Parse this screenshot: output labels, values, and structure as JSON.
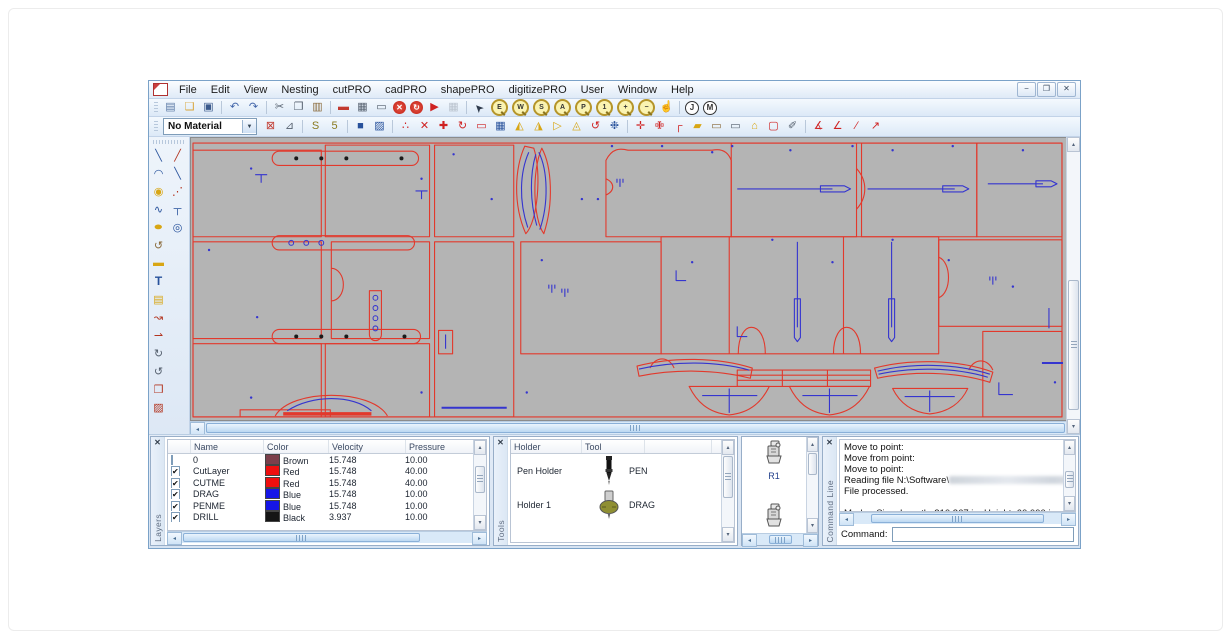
{
  "window": {
    "controls": [
      {
        "name": "minimize-button",
        "glyph": "−"
      },
      {
        "name": "restore-button",
        "glyph": "❐"
      },
      {
        "name": "close-button",
        "glyph": "✕"
      }
    ]
  },
  "menu": {
    "items": [
      "File",
      "Edit",
      "View",
      "Nesting",
      "cutPRO",
      "cadPRO",
      "shapePRO",
      "digitizePRO",
      "User",
      "Window",
      "Help"
    ]
  },
  "toolbar_main": {
    "groups": [
      [
        {
          "n": "new-drawing-icon",
          "g": "▤",
          "c": "#5b79a5"
        },
        {
          "n": "open-file-icon",
          "g": "❑",
          "c": "#d9a437"
        },
        {
          "n": "save-icon",
          "g": "▣",
          "c": "#3b5a8c"
        }
      ],
      [
        {
          "n": "undo-icon",
          "g": "↶",
          "c": "#3f63a8"
        },
        {
          "n": "redo-icon",
          "g": "↷",
          "c": "#3f63a8"
        }
      ],
      [
        {
          "n": "cut-icon",
          "g": "✂",
          "c": "#55606e"
        },
        {
          "n": "copy-icon",
          "g": "❐",
          "c": "#55606e"
        },
        {
          "n": "paste-icon",
          "g": "▥",
          "c": "#8a6a3a"
        }
      ],
      [
        {
          "n": "material-editor-icon",
          "g": "▬",
          "c": "#c23a2f"
        },
        {
          "n": "plot-setup-icon",
          "g": "▦",
          "c": "#55606e"
        },
        {
          "n": "machine-setup-icon",
          "g": "▭",
          "c": "#55606e"
        },
        {
          "n": "stop-icon",
          "g": "✕",
          "k": "circ-red"
        },
        {
          "n": "restart-icon",
          "g": "↻",
          "k": "circ-red"
        },
        {
          "n": "start-icon",
          "g": "▶",
          "c": "#cf2222"
        },
        {
          "n": "pause-icon",
          "g": "▦",
          "c": "#b9c2cd"
        }
      ],
      [
        {
          "n": "select-cursor-icon",
          "g": "➤",
          "c": "#2f3b4c",
          "k": "rot225"
        },
        {
          "n": "zoom-extents-icon",
          "lens": "E"
        },
        {
          "n": "zoom-window-icon",
          "lens": "W"
        },
        {
          "n": "zoom-selected-icon",
          "lens": "S"
        },
        {
          "n": "zoom-all-icon",
          "lens": "A"
        },
        {
          "n": "zoom-previous-icon",
          "lens": "P"
        },
        {
          "n": "zoom-scale-icon",
          "lens": "1"
        },
        {
          "n": "zoom-in-icon",
          "lens": "+"
        },
        {
          "n": "zoom-out-icon",
          "lens": "−"
        },
        {
          "n": "pan-hand-icon",
          "g": "☝",
          "c": "#c59f33"
        }
      ],
      [
        {
          "n": "job-tool-icon",
          "circle": "J"
        },
        {
          "n": "machine-tool-icon",
          "circle": "M"
        }
      ]
    ]
  },
  "toolbar_secondary": {
    "material_select": {
      "value": "No Material"
    },
    "groups": [
      [
        {
          "n": "delete-material-icon",
          "g": "⊠",
          "c": "#c23a2f"
        },
        {
          "n": "measure-icon",
          "g": "⊿",
          "c": "#55606e"
        }
      ],
      [
        {
          "n": "step-repeat-icon",
          "g": "S",
          "c": "#8a7a1f"
        },
        {
          "n": "step-repeat-add-icon",
          "g": "5",
          "c": "#8a7a1f"
        }
      ],
      [
        {
          "n": "fill-dark-icon",
          "g": "■",
          "c": "#27519b"
        },
        {
          "n": "fill-light-icon",
          "g": "▨",
          "c": "#27519b"
        }
      ],
      [
        {
          "n": "point-edit-icon",
          "g": "∴",
          "c": "#cf2222"
        },
        {
          "n": "delete-icon",
          "g": "✕",
          "c": "#cf2222"
        },
        {
          "n": "move-icon",
          "g": "✚",
          "c": "#cf2222"
        },
        {
          "n": "rotate-icon",
          "g": "↻",
          "c": "#cf2222"
        },
        {
          "n": "properties-icon",
          "g": "▭",
          "c": "#cf2222"
        },
        {
          "n": "array-icon",
          "g": "▦",
          "c": "#27519b"
        },
        {
          "n": "mirror-horizontal-icon",
          "g": "◭",
          "c": "#d8a614"
        },
        {
          "n": "mirror-vertical-icon",
          "g": "◮",
          "c": "#d8a614"
        },
        {
          "n": "skew-icon",
          "g": "▷",
          "c": "#d8a614"
        },
        {
          "n": "align-warning-icon",
          "g": "◬",
          "c": "#d8a614"
        },
        {
          "n": "rotate-ccw-icon",
          "g": "↺",
          "c": "#cf2222"
        },
        {
          "n": "spray-icon",
          "g": "❉",
          "c": "#27519b"
        }
      ],
      [
        {
          "n": "break-line-icon",
          "g": "✛",
          "c": "#cf2222"
        },
        {
          "n": "join-line-icon",
          "g": "✙",
          "c": "#cf2222"
        },
        {
          "n": "corner-icon",
          "g": "┌",
          "c": "#cf2222"
        },
        {
          "n": "fillet-icon",
          "g": "▰",
          "c": "#d8a614"
        },
        {
          "n": "open-shape-icon",
          "g": "▭",
          "c": "#8a6a3a"
        },
        {
          "n": "close-shape-icon",
          "g": "▭",
          "c": "#55606e"
        },
        {
          "n": "polygon-icon",
          "g": "⌂",
          "c": "#d8a614"
        },
        {
          "n": "marquee-icon",
          "g": "▢",
          "c": "#cf2222"
        },
        {
          "n": "knife-icon",
          "g": "✐",
          "c": "#55606e"
        }
      ],
      [
        {
          "n": "angle-measure-icon",
          "g": "∡",
          "c": "#cf2222"
        },
        {
          "n": "angle-icon",
          "g": "∠",
          "c": "#cf2222"
        },
        {
          "n": "segment-icon",
          "g": "∕",
          "c": "#cf2222"
        },
        {
          "n": "segment-points-icon",
          "g": "↗",
          "c": "#cf2222"
        }
      ]
    ]
  },
  "toolbox": {
    "left_column": [
      {
        "n": "line-tool-icon",
        "g": "╲",
        "c": "#27519b"
      },
      {
        "n": "arc-tool-icon",
        "g": "◠",
        "c": "#27519b"
      },
      {
        "n": "circle-tool-icon",
        "g": "◉",
        "c": "#d8a614"
      },
      {
        "n": "polyline-tool-icon",
        "g": "∿",
        "c": "#27519b"
      },
      {
        "n": "ellipse-tool-icon",
        "g": "●",
        "c": "#d8a614",
        "k": "stretchx"
      },
      {
        "n": "revolve-tool-icon",
        "g": "↺",
        "c": "#8a6a3a"
      },
      {
        "n": "rectangle-tool-icon",
        "g": "▬",
        "c": "#d8a614"
      },
      {
        "n": "text-tool-icon",
        "g": "T",
        "c": "#27519b",
        "k": "boldT"
      },
      {
        "n": "dimension-tool-icon",
        "g": "▤",
        "c": "#d8a614"
      },
      {
        "n": "edit-points-tool-icon",
        "g": "↝",
        "c": "#b2341f"
      },
      {
        "n": "vector-tool-icon",
        "g": "⇀",
        "c": "#b2341f"
      },
      {
        "n": "rotate-cw-tool-icon",
        "g": "↻",
        "c": "#55606e"
      },
      {
        "n": "rotate-ccw-tool-icon",
        "g": "↺",
        "c": "#55606e"
      },
      {
        "n": "send-to-cut-icon",
        "g": "❒",
        "c": "#b2341f"
      },
      {
        "n": "export-marker-icon",
        "g": "▨",
        "c": "#b2341f"
      }
    ],
    "right_column": [
      {
        "n": "point-on-line-tool-icon",
        "g": "╱",
        "c": "#b2341f"
      },
      {
        "n": "offset-line-tool-icon",
        "g": "╲",
        "c": "#27519b"
      },
      {
        "n": "divide-line-tool-icon",
        "g": "⋰",
        "c": "#b2341f"
      },
      {
        "n": "tee-point-tool-icon",
        "g": "┬",
        "c": "#27519b"
      },
      {
        "n": "center-point-tool-icon",
        "g": "◎",
        "c": "#27519b"
      }
    ]
  },
  "canvas": {
    "bg": "#b4b4b4",
    "stroke_red": "#e2392c",
    "stroke_blue": "#3535cf",
    "dot_black": "#1a1a1a",
    "red_paths": [
      {
        "d": "M2,5H869V274H2Z"
      },
      {
        "d": "M2,12H130V97H2Z"
      },
      {
        "d": "M2,102H130V197H2Z"
      },
      {
        "d": "M2,202H130V274H2Z"
      },
      {
        "d": "M88,13H220a7,7 0 0 1 0,14H88a7,7 0 0 1 0,-14Z"
      },
      {
        "d": "M88,96H216a7,7 0 0 1 0,14H88a7,7 0 0 1 0,-14Z"
      },
      {
        "d": "M88,188H222a7,7 0 0 1 0,14H88a7,7 0 0 1 0,-14Z"
      },
      {
        "d": "M178,150H190V193a6,6 0 0 1 -12,0Z"
      },
      {
        "d": "M134,7H238V97H134Z"
      },
      {
        "d": "M140,102H238V197H140Z"
      },
      {
        "d": "M140,128a12,16 0 0 1 0,32"
      },
      {
        "d": "M134,202H238V274H134Z"
      },
      {
        "d": "M243,7H322V97H243Z"
      },
      {
        "d": "M243,102H322V274H243Z"
      },
      {
        "d": "M247,189h14v23h-14z"
      },
      {
        "d": "M333,8C323,30 321,65 334,94C346,82 350,34 342,10Z"
      },
      {
        "d": "M350,10C360,28 362,64 352,94C341,79 340,32 350,10Z"
      },
      {
        "d": "M414,22C420,10 428,10 436,12L520,12C530,10 536,14 539,22L539,97L414,97Z"
      },
      {
        "d": "M414,40C423,44 423,52 414,56"
      },
      {
        "d": "M539,5H664V97H539Z"
      },
      {
        "d": "M664,30C675,42 675,58 664,70"
      },
      {
        "d": "M669,5H784V97H669Z"
      },
      {
        "d": "M784,5H869V97H784Z"
      },
      {
        "d": "M329,102H469V212H329Z"
      },
      {
        "d": "M469,97H746V212H469Z"
      },
      {
        "d": "M537,97V212"
      },
      {
        "d": "M651,97V212"
      },
      {
        "d": "M546,212C546,194 553,186 559,186C566,186 573,194 573,212"
      },
      {
        "d": "M641,212C641,194 648,186 654,186C661,186 668,194 668,212"
      },
      {
        "d": "M746,100H869V185H746Z"
      },
      {
        "d": "M746,117C759,122 759,152 746,157"
      },
      {
        "d": "M790,190H869V274H790Z"
      },
      {
        "d": "M84,273C100,246 180,246 196,273"
      },
      {
        "d": "M92,271H180",
        "w": 3.5
      },
      {
        "d": "M445,224C480,215 525,215 560,226L558,236C523,227 482,227 447,234Z"
      },
      {
        "d": "M545,228H678V244H545Z"
      },
      {
        "d": "M545,233H678"
      },
      {
        "d": "M545,238H678"
      },
      {
        "d": "M590,228V244"
      },
      {
        "d": "M635,228V244"
      },
      {
        "d": "M682,226C716,217 764,217 800,230L797,240C762,229 718,229 685,236Z"
      },
      {
        "d": "M497,244H577C570,258 559,270 537,272C515,270 504,258 497,244Z"
      },
      {
        "d": "M597,244H677C670,258 659,270 637,272C615,270 604,258 597,244Z"
      },
      {
        "d": "M700,246H775C769,259 757,269 737,271C717,269 706,258 700,246Z"
      },
      {
        "d": "M49,267H139V274H49Z"
      },
      {
        "d": "M458,226C463,214 477,214 482,226"
      },
      {
        "d": "M776,228C781,216 795,216 800,228"
      }
    ],
    "blue_paths": [
      {
        "d": "M254,193v14"
      },
      {
        "d": "M250,265H315",
        "w": 2
      },
      {
        "d": "M337,14C328,34 327,62 336,88"
      },
      {
        "d": "M347,14C356,32 357,64 348,90"
      },
      {
        "d": "M344,16C338,36 338,62 345,86"
      },
      {
        "d": "M545,50H640"
      },
      {
        "d": "M628,47H652L658,50L652,53H628Z"
      },
      {
        "d": "M675,50H762"
      },
      {
        "d": "M750,47H770L776,50L770,53H750Z"
      },
      {
        "d": "M795,45H850"
      },
      {
        "d": "M843,42H858L864,45L858,48H843Z"
      },
      {
        "d": "M605,102V186"
      },
      {
        "d": "M602,158H608V196L605,200L602,196Z"
      },
      {
        "d": "M699,102V186"
      },
      {
        "d": "M696,158H702V196L699,200L696,196Z"
      },
      {
        "d": "M484,130V140H494"
      },
      {
        "d": "M545,185V195H555"
      },
      {
        "d": "M806,240V252H820"
      },
      {
        "d": "M96,268C120,252 162,252 180,268"
      },
      {
        "d": "M447,227C482,219 524,219 557,228"
      },
      {
        "d": "M685,229C718,221 762,221 797,232"
      },
      {
        "d": "M686,232C719,225 761,225 795,235"
      },
      {
        "d": "M537,246V270M510,253H565"
      },
      {
        "d": "M637,246V270M610,253H665"
      },
      {
        "d": "M737,248V269M712,254H762"
      },
      {
        "d": "M856,167V187"
      },
      {
        "d": "M849,221H870",
        "w": 2
      },
      {
        "d": "M64,36H76M70,36V44"
      },
      {
        "d": "M224,52H236M230,52V60"
      },
      {
        "d": "M428,40v8M425,40v4M431,40v4"
      },
      {
        "d": "M800,136v8M797,136v4M803,136v4"
      },
      {
        "d": "M360,144v8M357,144v4M363,144v4"
      },
      {
        "d": "M373,148v8M370,148v4M376,148v4"
      }
    ],
    "black_dots": [
      [
        105,
        20
      ],
      [
        130,
        20
      ],
      [
        155,
        20
      ],
      [
        210,
        20
      ],
      [
        105,
        195
      ],
      [
        130,
        195
      ],
      [
        155,
        195
      ],
      [
        213,
        195
      ]
    ],
    "rings": [
      [
        100,
        103
      ],
      [
        115,
        103
      ],
      [
        130,
        103
      ],
      [
        184,
        157
      ],
      [
        184,
        167
      ],
      [
        184,
        177
      ],
      [
        184,
        187
      ]
    ],
    "blue_dots": [
      [
        60,
        30
      ],
      [
        18,
        110
      ],
      [
        66,
        176
      ],
      [
        230,
        40
      ],
      [
        262,
        16
      ],
      [
        300,
        60
      ],
      [
        390,
        60
      ],
      [
        420,
        8
      ],
      [
        470,
        8
      ],
      [
        540,
        8
      ],
      [
        598,
        12
      ],
      [
        660,
        8
      ],
      [
        700,
        12
      ],
      [
        760,
        8
      ],
      [
        830,
        12
      ],
      [
        350,
        120
      ],
      [
        500,
        122
      ],
      [
        640,
        122
      ],
      [
        756,
        120
      ],
      [
        820,
        146
      ],
      [
        60,
        255
      ],
      [
        230,
        250
      ],
      [
        335,
        250
      ],
      [
        580,
        100
      ],
      [
        700,
        100
      ],
      [
        862,
        240
      ],
      [
        406,
        60
      ],
      [
        520,
        14
      ]
    ]
  },
  "panels": {
    "layers": {
      "title": "Layers",
      "columns": [
        "",
        "Name",
        "Color",
        "Velocity",
        "Pressure",
        "Tool Name",
        "Le"
      ],
      "rows": [
        {
          "checked": false,
          "name": "0",
          "color": "Brown",
          "hex": "#7b3f4b",
          "velocity": "15.748",
          "pressure": "10.00",
          "tool": "DRAG",
          "len": "0.0"
        },
        {
          "checked": true,
          "name": "CutLayer",
          "color": "Red",
          "hex": "#ee0f0f",
          "velocity": "15.748",
          "pressure": "40.00",
          "tool": "DRAG",
          "len": "0.0"
        },
        {
          "checked": true,
          "name": "CUTME",
          "color": "Red",
          "hex": "#ee0f0f",
          "velocity": "15.748",
          "pressure": "40.00",
          "tool": "DRAG",
          "len": "0.0"
        },
        {
          "checked": true,
          "name": "DRAG",
          "color": "Blue",
          "hex": "#1515e6",
          "velocity": "15.748",
          "pressure": "10.00",
          "tool": "DRAG",
          "len": "0.0"
        },
        {
          "checked": true,
          "name": "PENME",
          "color": "Blue",
          "hex": "#1515e6",
          "velocity": "15.748",
          "pressure": "10.00",
          "tool": "PEN",
          "len": "0.0"
        },
        {
          "checked": true,
          "name": "DRILL",
          "color": "Black",
          "hex": "#151515",
          "velocity": "3.937",
          "pressure": "10.00",
          "tool": "R1",
          "len": "0.0"
        }
      ]
    },
    "tools": {
      "title": "Tools",
      "columns": [
        "Holder",
        "Tool",
        ""
      ],
      "rows": [
        {
          "holder": "Pen Holder",
          "tool": "PEN",
          "icon": "pen-tool-icon"
        },
        {
          "holder": "Holder 1",
          "tool": "DRAG",
          "icon": "drag-knife-icon"
        }
      ]
    },
    "tool_gallery": {
      "items": [
        {
          "label": "R1"
        },
        {
          "label": ""
        }
      ]
    },
    "command_line": {
      "title": "Command Line",
      "lines": [
        "Move to point:",
        "Move from point:",
        "Move to point:",
        "Reading file N:\\Software\\",
        "File processed.",
        "",
        "Marker Size: Length: 210.367 in  Height: 60.000 in"
      ],
      "redacted_after_index": 3,
      "prompt_label": "Command:",
      "input_value": ""
    }
  }
}
